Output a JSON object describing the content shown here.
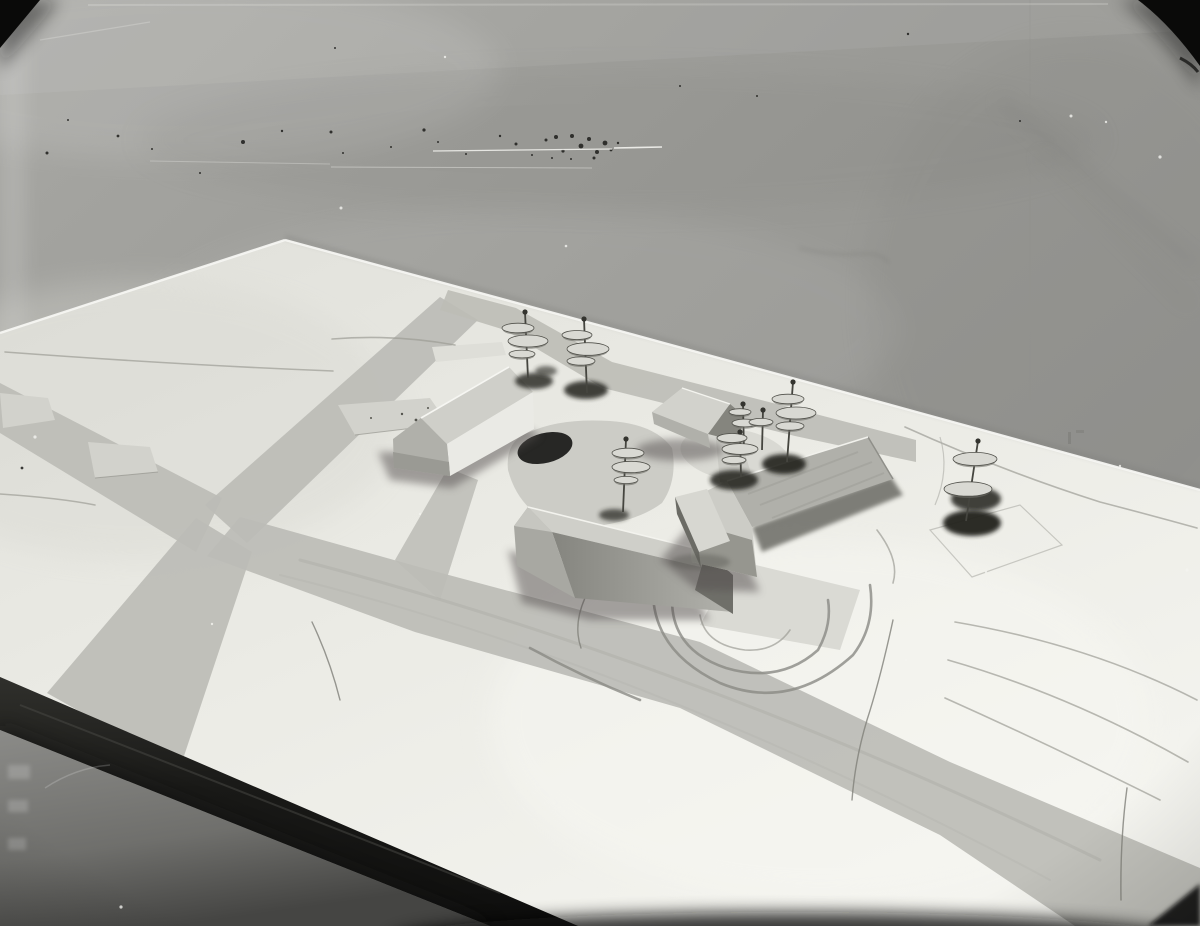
{
  "scene": {
    "type": "black-and-white photograph",
    "medium": "archival glass-plate photograph with dust, scratches and dark corner masks",
    "subject": "architectural site model photographed against a plain grey backdrop",
    "description": "A monochrome photo of a white architectural massing model: four gabled buildings and pin trees with stacked metal discs stand on a contoured terrain board with painted grey roads crossing it; the dark front edge of the board and the grey floor show at lower left."
  },
  "photo": {
    "width": 1200,
    "height": 926
  },
  "objects": {
    "backdrop": "plain grey studio backdrop",
    "board": "white contoured terrain model board",
    "board_front_edge": "dark painted board edge",
    "floor": "grey floor below the model table",
    "buildings": [
      {
        "id": "building-1",
        "label": "long gabled building, north-west"
      },
      {
        "id": "building-2",
        "label": "long gabled building, centre"
      },
      {
        "id": "building-3",
        "label": "large gabled building with low annex, east"
      },
      {
        "id": "building-4",
        "label": "small gabled house, north"
      }
    ],
    "roads": [
      "west road",
      "north-east road",
      "south-west road",
      "main south-east road",
      "back-edge road",
      "courtyard spur"
    ],
    "tree_pin_count": 8
  },
  "colors": {
    "backdrop": "#9b9b97",
    "board": "#efefe9",
    "road": "#bcbcb6",
    "slab": "#d2d2cc",
    "patch": "#c7c7c1",
    "roof_light": "#cfcfc9",
    "roof_mid": "#b0b0aa",
    "wall_white": "#eaeae5",
    "gable_mid": "#b0b0aa",
    "gable_dark": "#6f6f69",
    "shadow": "#55504f",
    "pin_metal": "#45453f",
    "pin_disc": "#d9d9d3",
    "pin_disc_dark": "#6e6e68",
    "pin_shadow": "#23231f",
    "edge_dark": "#1b1b19",
    "floor": "#7e7e7b",
    "corner_black": "#0a0a09",
    "speck_dark": "#1c1c1a",
    "speck_light": "#f4f4f0",
    "highlight": "#f6f6f2"
  },
  "trees": [
    {
      "x": 528,
      "y": 378,
      "h": 66,
      "tilt": -3,
      "discs": [
        [
          -7,
          16,
          16
        ],
        [
          3,
          29,
          20
        ],
        [
          -3,
          42,
          13
        ]
      ],
      "shadows": [
        [
          6,
          3,
          19,
          8,
          0.8
        ],
        [
          18,
          -7,
          11,
          5,
          0.6
        ]
      ]
    },
    {
      "x": 587,
      "y": 393,
      "h": 74,
      "tilt": -3,
      "discs": [
        [
          -7,
          16,
          15
        ],
        [
          4,
          30,
          21
        ],
        [
          -3,
          42,
          14
        ]
      ],
      "shadows": [
        [
          -1,
          -3,
          22,
          9,
          0.85
        ]
      ]
    },
    {
      "x": 623,
      "y": 512,
      "h": 73,
      "tilt": 3,
      "discs": [
        [
          2,
          14,
          16
        ],
        [
          5,
          28,
          19
        ],
        [
          0,
          41,
          12
        ]
      ],
      "shadows": [
        [
          -9,
          3,
          15,
          6,
          0.7
        ]
      ]
    },
    {
      "x": 744,
      "y": 452,
      "h": 48,
      "tilt": -1,
      "discs": [
        [
          -3,
          8,
          11
        ],
        [
          2,
          19,
          13
        ]
      ],
      "shadows": []
    },
    {
      "x": 762,
      "y": 450,
      "h": 40,
      "tilt": 1,
      "discs": [
        [
          -2,
          12,
          12
        ]
      ],
      "shadows": []
    },
    {
      "x": 741,
      "y": 477,
      "h": 45,
      "tilt": -1,
      "discs": [
        [
          -8,
          6,
          15
        ],
        [
          0,
          17,
          18
        ],
        [
          -6,
          28,
          12
        ]
      ],
      "shadows": [
        [
          -7,
          3,
          24,
          10,
          0.85
        ]
      ]
    },
    {
      "x": 787,
      "y": 462,
      "h": 80,
      "tilt": 6,
      "discs": [
        [
          -5,
          17,
          16
        ],
        [
          3,
          31,
          20
        ],
        [
          -3,
          44,
          14
        ]
      ],
      "shadows": [
        [
          -3,
          2,
          22,
          10,
          0.9
        ]
      ]
    },
    {
      "x": 966,
      "y": 521,
      "h": 80,
      "tilt": 12,
      "discs": [
        [
          -3,
          18,
          22
        ],
        [
          -10,
          48,
          24
        ]
      ],
      "shadows": [
        [
          10,
          -22,
          25,
          12,
          0.85
        ],
        [
          6,
          2,
          29,
          13,
          0.95
        ]
      ]
    }
  ],
  "specks": {
    "dark": [
      [
        47,
        153,
        1.5
      ],
      [
        118,
        136,
        1.4
      ],
      [
        152,
        149,
        1
      ],
      [
        243,
        142,
        2
      ],
      [
        282,
        131,
        1.2
      ],
      [
        331,
        132,
        1.5
      ],
      [
        343,
        153,
        1
      ],
      [
        391,
        147,
        1
      ],
      [
        424,
        130,
        1.6
      ],
      [
        438,
        142,
        1
      ],
      [
        466,
        154,
        1
      ],
      [
        500,
        136,
        1.2
      ],
      [
        516,
        144,
        1.5
      ],
      [
        532,
        155,
        1
      ],
      [
        546,
        140,
        1.5
      ],
      [
        556,
        137,
        2
      ],
      [
        563,
        151,
        1.6
      ],
      [
        572,
        136,
        2
      ],
      [
        581,
        146,
        2.4
      ],
      [
        589,
        139,
        2
      ],
      [
        597,
        152,
        2
      ],
      [
        605,
        143,
        2.4
      ],
      [
        594,
        158,
        1.5
      ],
      [
        611,
        150,
        1.4
      ],
      [
        571,
        159,
        1
      ],
      [
        552,
        158,
        1
      ],
      [
        618,
        143,
        1.2
      ],
      [
        68,
        120,
        1
      ],
      [
        200,
        173,
        1
      ],
      [
        908,
        34,
        1.2
      ],
      [
        1020,
        121,
        1
      ],
      [
        757,
        96,
        1
      ],
      [
        680,
        86,
        1
      ],
      [
        22,
        468,
        1.4
      ],
      [
        335,
        48,
        1
      ]
    ],
    "light": [
      [
        35,
        437,
        1.6
      ],
      [
        341,
        208,
        1.5
      ],
      [
        420,
        514,
        1.1
      ],
      [
        1071,
        116,
        1.5
      ],
      [
        1106,
        122,
        1.2
      ],
      [
        1160,
        157,
        1.6
      ],
      [
        212,
        624,
        1.2
      ],
      [
        649,
        801,
        1.5
      ],
      [
        121,
        907,
        1.6
      ],
      [
        445,
        57,
        1.2
      ],
      [
        986,
        572,
        1.2
      ],
      [
        1187,
        570,
        1.5
      ],
      [
        1120,
        466,
        1.2
      ],
      [
        566,
        246,
        1.3
      ],
      [
        906,
        660,
        1.3
      ],
      [
        790,
        880,
        1.4
      ]
    ]
  },
  "scratches": [
    [
      433,
      151,
      612,
      149,
      1.2,
      0.85
    ],
    [
      614,
      148,
      662,
      147,
      1.6,
      0.9
    ],
    [
      331,
      167,
      592,
      168,
      1,
      0.4
    ],
    [
      150,
      161,
      330,
      164,
      1,
      0.3
    ],
    [
      88,
      5,
      1108,
      4,
      2,
      0.2
    ],
    [
      40,
      40,
      150,
      22,
      1.2,
      0.25
    ]
  ]
}
